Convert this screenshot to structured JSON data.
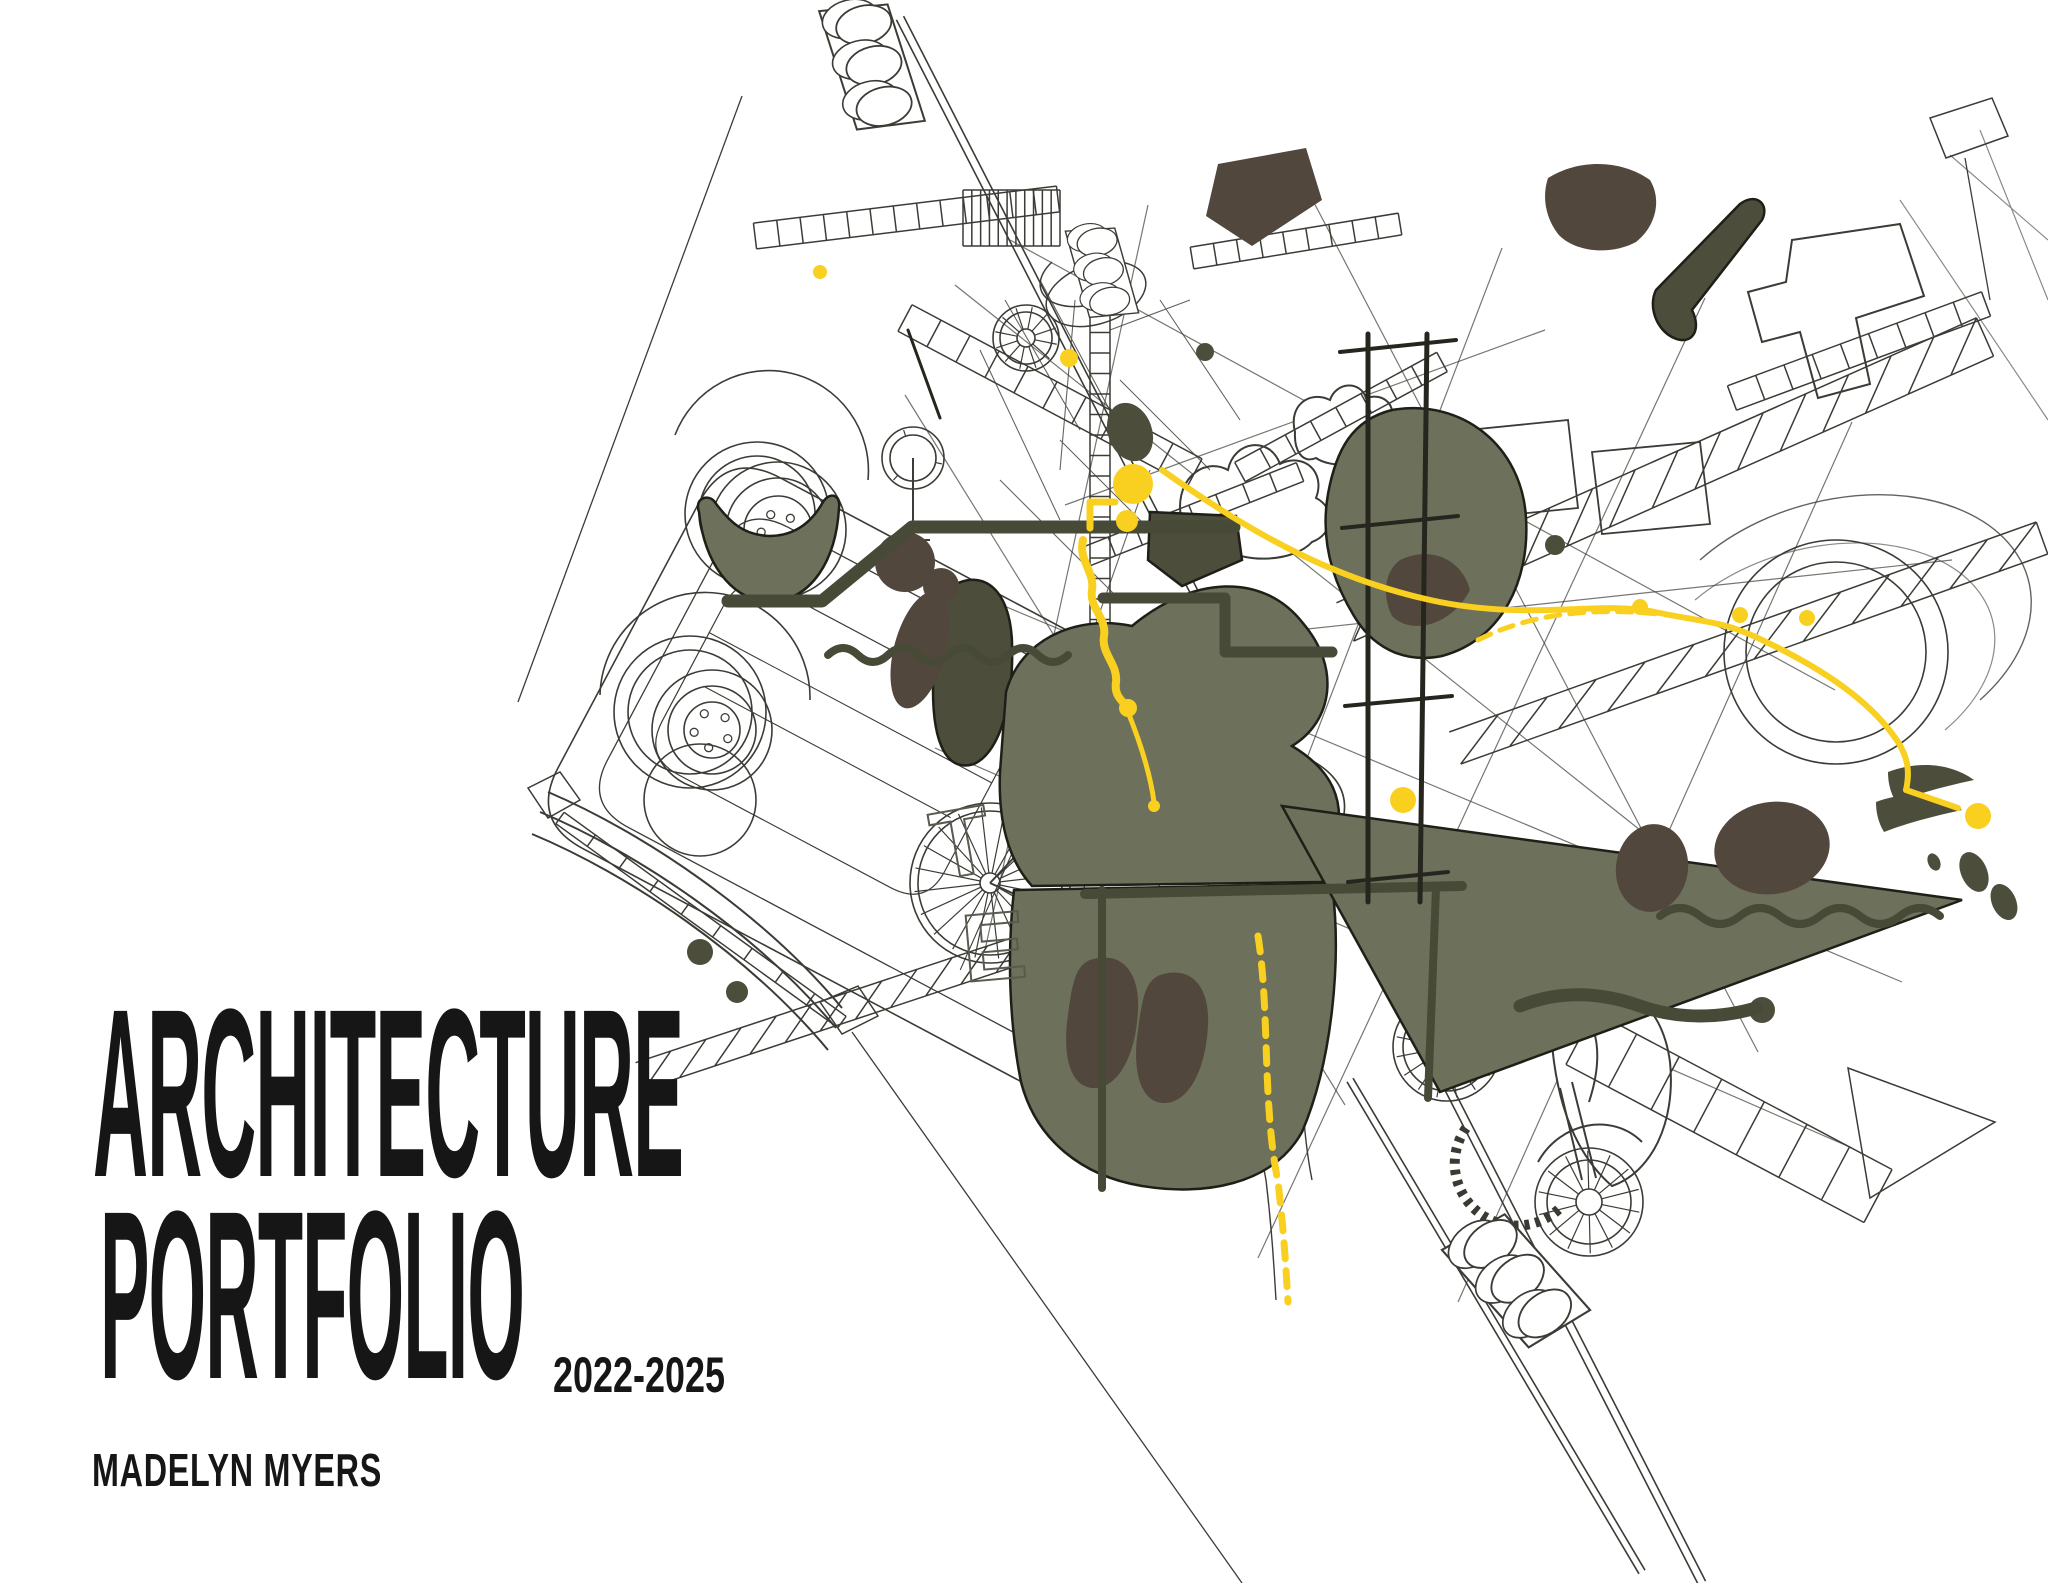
{
  "title": {
    "line1": "ARCHITECTURE",
    "line2": "PORTFOLIO",
    "years": "2022-2025"
  },
  "author": "MADELYN MYERS",
  "colors": {
    "paper": "#ffffff",
    "ink": "#161616",
    "wire": "#3c3c36",
    "olive": "#6d705a",
    "olive_dark": "#4c4e3b",
    "dark_brown": "#52473d",
    "accent": "#f9d020",
    "tube": "#484a38"
  },
  "illustration": {
    "description": "exploded isometric collage of wireframe vehicles, scaffolding, ladders and traffic lights with olive silhouettes and yellow wayfinding dots",
    "wires": [
      {
        "d": "M-270,-210 L330,-210 Q390,-210 390,-150 L390,150 Q390,210 330,210 L-270,210 Q-330,210 -330,150 L-330,-150 Q-330,-210 -270,-210 Z",
        "tf": "translate(920,790) rotate(28)",
        "w": 1.6
      },
      {
        "d": "M-240,-170 L300,-170 Q350,-170 350,-120 L350,120 Q350,170 300,170 L-240,170 Q-290,170 -290,120 L-290,-120 Q-290,-170 -240,-170 Z",
        "tf": "translate(920,790) rotate(28)",
        "w": 1.3
      },
      {
        "d": "M-220,-110 L20,-110 Q60,-110 60,-70 L60,60 Q60,100 20,100 L-220,100 Q-260,100 -260,60 L-260,-70 Q-260,-110 -220,-110 Z",
        "tf": "translate(920,790) rotate(28)",
        "w": 1.2
      },
      {
        "d": "M-260,-40 L60,-40 M-240,10 L40,10 M100,-140 L120,140 M180,-150 L200,150 M250,-160 L265,160",
        "tf": "translate(920,790) rotate(28)",
        "w": 1.1
      },
      {
        "d": "M675,435 A100,100 0 0 1 868,480",
        "w": 1.6
      },
      {
        "d": "M600,695 A105,105 0 0 1 810,700",
        "w": 1.6
      },
      {
        "d": "M913,458 L913,540 M898,540 L930,540",
        "w": 2
      },
      {
        "d": "M955,285 L1640,830",
        "w": 1.2,
        "o": 0.7
      },
      {
        "d": "M1010,240 L1835,690",
        "w": 1.2,
        "o": 0.7
      },
      {
        "d": "M905,395 L1345,1105",
        "w": 1.2,
        "o": 0.7
      },
      {
        "d": "M1148,205 L985,950",
        "w": 1.2,
        "o": 0.7
      },
      {
        "d": "M1298,172 L1758,1052",
        "w": 1.2,
        "o": 0.7
      },
      {
        "d": "M1502,248 L1158,1148",
        "w": 1.2,
        "o": 0.7
      },
      {
        "d": "M1705,298 L1258,1258",
        "w": 1.2,
        "o": 0.7
      },
      {
        "d": "M1852,422 L1458,1302",
        "w": 1.2,
        "o": 0.7
      },
      {
        "d": "M985,598 L1902,982",
        "w": 1.2,
        "o": 0.7
      },
      {
        "d": "M935,748 L1852,1148",
        "w": 1.2,
        "o": 0.7
      },
      {
        "d": "M1065,505 L1545,330",
        "w": 1.2,
        "o": 0.7
      },
      {
        "d": "M1205,640 L1952,560",
        "w": 1.2,
        "o": 0.7
      },
      {
        "d": "M1182,522 C1172,482 1202,456 1228,470 C1234,440 1270,436 1280,464 C1304,452 1326,472 1316,498 C1336,508 1334,534 1312,542 C1294,562 1244,564 1224,548 C1202,558 1184,546 1182,522 Z",
        "f": "#ffffff",
        "w": 2
      },
      {
        "d": "M1295,432 C1288,405 1310,390 1330,400 C1336,382 1360,380 1366,398 C1384,392 1398,406 1390,424 C1402,432 1398,450 1382,454 C1368,468 1330,468 1316,458 C1302,464 1294,450 1295,432 Z",
        "f": "#ffffff",
        "w": 2
      },
      {
        "d": "M1792,240 L1900,224 L1924,296 L1856,318 L1870,384 L1818,398 L1800,332 L1762,342 L1748,292 L1786,282 Z",
        "f": "#ffffff",
        "w": 2
      },
      {
        "d": "M1556,988 C1622,970 1662,1002 1670,1062 C1676,1122 1652,1172 1612,1186 C1582,1160 1562,1120 1554,1062 C1550,1030 1550,1008 1556,988 Z",
        "f": "#ffffff",
        "w": 2
      },
      {
        "d": "M548,792 C642,832 762,912 842,1008",
        "w": 2
      },
      {
        "d": "M540,812 C636,852 756,932 836,1028",
        "w": 2
      },
      {
        "d": "M532,834 C628,874 748,954 828,1050",
        "w": 2
      },
      {
        "d": "M528,788 L560,772 L580,800 L548,818 Z",
        "w": 1.5
      },
      {
        "d": "M820,1002 L858,986 L878,1016 L842,1034 Z",
        "w": 1.5
      },
      {
        "d": "M1848,1068 L1995,1122 L1870,1198 Z",
        "w": 1.5
      },
      {
        "d": "M1930,118 L1992,98 L2008,136 L1946,158 Z",
        "w": 1.5
      },
      {
        "d": "M1965,158 L1990,300",
        "w": 1.3
      },
      {
        "d": "M1447,1047 C1482,1002 1532,982 1572,1002 C1602,1022 1602,1062 1589,1102",
        "w": 2
      },
      {
        "d": "M1560,1088 L1582,1180 M1572,1082 L1596,1178",
        "w": 2
      },
      {
        "d": "M1538,1162 C1560,1122 1612,1112 1642,1142",
        "w": 2
      },
      {
        "d": "M990,883 L1085,782 L1152,852 M990,883 L1098,932",
        "w": 2
      },
      {
        "d": "M1058,282 A38,22 -18 1 0 1134,306 A38,22 -18 1 0 1058,282 Z",
        "w": 1.5
      },
      {
        "d": "M1052,262 A38,22 -18 1 0 1128,286",
        "w": 1.5
      },
      {
        "d": "M1448,432 L1568,420 L1578,508 L1458,520 Z",
        "w": 1.8
      },
      {
        "d": "M1592,452 L1700,442 L1710,524 L1602,534 Z",
        "w": 1.8
      },
      {
        "d": "M1466,1128 A62,62 0 0 0 1562,1206",
        "w": 10,
        "s": "#3a3a33",
        "dash": "5 6"
      },
      {
        "d": "M1005,300 L1080,430 M1040,280 L1115,420 M1075,300 L1060,470 M1110,330 L1190,300 M980,350 L1060,520 M1120,380 L1210,470 M1160,300 L1240,420 M1060,440 L1180,560 M1000,480 L1120,600 M1150,470 L1090,640",
        "w": 1.1,
        "o": 0.8
      },
      {
        "d": "M1950,155 L2048,240 M1980,130 L2048,300 M1900,200 L2048,420",
        "w": 1.2,
        "o": 0.6
      },
      {
        "d": "M1700,560 A180,120 -15 0 1 1980,700",
        "w": 1.4,
        "o": 0.8
      },
      {
        "d": "M1695,600 A160,105 -15 0 1 1945,730",
        "w": 1.2,
        "o": 0.6
      },
      {
        "d": "M1246,930 C1258,1010 1250,1100 1266,1180 C1272,1230 1274,1268 1276,1300 M1292,930 C1304,1010 1296,1100 1312,1180",
        "w": 1.4
      }
    ],
    "ladders": [
      {
        "p": [
          755,
          236,
          1058,
          199
        ],
        "w": 26,
        "n": 13
      },
      {
        "p": [
          1192,
          258,
          1400,
          224
        ],
        "w": 22,
        "n": 9
      },
      {
        "p": [
          963,
          218,
          1060,
          218
        ],
        "w": 56,
        "n": 11
      },
      {
        "p": [
          905,
          318,
          1195,
          472
        ],
        "w": 30,
        "n": 10
      },
      {
        "p": [
          1240,
          472,
          1442,
          362
        ],
        "w": 22,
        "n": 8
      },
      {
        "p": [
          1345,
          622,
          1985,
          337
        ],
        "w": 42,
        "n": 15,
        "lat": 1
      },
      {
        "p": [
          1455,
          748,
          2042,
          538
        ],
        "w": 34,
        "n": 12,
        "lat": 1
      },
      {
        "p": [
          640,
          1076,
          1062,
          936
        ],
        "w": 28,
        "n": 12,
        "lat": 1
      },
      {
        "p": [
          560,
          818,
          842,
          1022
        ],
        "w": 14,
        "n": 9
      },
      {
        "p": [
          1580,
          1038,
          1878,
          1196
        ],
        "w": 60,
        "n": 7
      },
      {
        "p": [
          1100,
          312,
          1100,
          640
        ],
        "w": 20,
        "n": 16
      },
      {
        "p": [
          1732,
          398,
          1986,
          304
        ],
        "w": 26,
        "n": 9
      },
      {
        "p": [
          1085,
          557,
          1300,
          472
        ],
        "w": 20,
        "n": 8
      }
    ],
    "poles": [
      [
        900,
        18,
        1702,
        1583,
        8
      ],
      [
        742,
        96,
        518,
        702,
        0
      ],
      [
        852,
        1032,
        1242,
        1583,
        0
      ],
      [
        1350,
        1080,
        1642,
        1572,
        7
      ]
    ],
    "lights": [
      {
        "cx": 872,
        "cy": 66,
        "rot": -14,
        "s": 1
      },
      {
        "cx": 1102,
        "cy": 272,
        "rot": -12,
        "s": 0.72
      },
      {
        "cx": 1516,
        "cy": 1280,
        "rot": -38,
        "s": 1.05
      }
    ],
    "wheels": [
      {
        "cx": 757,
        "cy": 514,
        "r": [
          72,
          58
        ]
      },
      {
        "cx": 778,
        "cy": 530,
        "r": [
          68,
          52,
          34
        ],
        "bolts": 5,
        "br": 17
      },
      {
        "cx": 690,
        "cy": 712,
        "r": [
          76,
          62
        ]
      },
      {
        "cx": 712,
        "cy": 730,
        "r": [
          60,
          44,
          28
        ],
        "bolts": 5,
        "br": 18
      },
      {
        "cx": 700,
        "cy": 800,
        "r": [
          56
        ]
      },
      {
        "cx": 913,
        "cy": 458,
        "r": [
          31,
          23
        ],
        "spokes": 3
      },
      {
        "cx": 1026,
        "cy": 338,
        "r": [
          33,
          26,
          9
        ],
        "spokes": 12
      },
      {
        "cx": 990,
        "cy": 883,
        "r": [
          80,
          72,
          10
        ],
        "spokes": 20
      },
      {
        "cx": 1104,
        "cy": 936,
        "r": [
          20
        ]
      },
      {
        "cx": 1447,
        "cy": 1047,
        "r": [
          54,
          44,
          14
        ],
        "spokes": 16
      },
      {
        "cx": 1589,
        "cy": 1202,
        "r": [
          54,
          42,
          13
        ],
        "spokes": 14
      },
      {
        "cx": 1836,
        "cy": 652,
        "r": [
          112,
          90
        ]
      }
    ],
    "blobs": [
      {
        "d": "M699,512 C694,498 708,494 714,501 C730,523 744,535 769,536 C797,536 813,520 823,502 C830,491 841,495 839,508 C836,560 812,600 770,602 C729,600 704,560 699,512 Z",
        "f": "olive"
      },
      {
        "d": "M1392,410 C1462,398 1522,446 1526,518 C1530,580 1502,640 1442,656 C1402,664 1372,646 1354,616 C1332,580 1320,540 1328,494 C1336,450 1352,420 1392,410 Z",
        "f": "olive"
      },
      {
        "d": "M1400,560 C1432,545 1462,560 1470,590 C1452,625 1412,636 1392,616 C1382,596 1384,572 1400,560 Z",
        "f": "dark",
        "ns": 1
      },
      {
        "d": "M952,586 C984,568 1010,590 1012,642 C1014,702 1000,752 974,764 C948,772 933,746 933,690 C933,640 932,602 952,586 Z",
        "f": "olive2"
      },
      {
        "d": "M1006,692 C1020,640 1076,614 1132,626 C1192,576 1262,572 1302,622 C1342,668 1332,722 1292,746 C1332,770 1346,800 1336,842 L1322,882 L1032,886 C1008,860 998,820 1000,772 Z",
        "f": "olive"
      },
      {
        "d": "M1014,890 L1332,884 C1342,960 1332,1062 1302,1132 C1272,1186 1202,1196 1142,1186 C1082,1176 1036,1140 1021,1082 C1009,1022 1007,952 1014,890 Z",
        "f": "olive"
      },
      {
        "d": "M1090,960 C1120,950 1140,970 1138,1010 C1136,1055 1118,1090 1092,1088 C1070,1086 1062,1055 1068,1015 C1072,985 1075,966 1090,960 Z",
        "f": "dark",
        "ns": 1
      },
      {
        "d": "M1160,975 C1190,965 1210,985 1208,1025 C1206,1070 1188,1105 1162,1103 C1140,1101 1132,1070 1138,1030 C1142,1000 1145,981 1160,975 Z",
        "f": "dark",
        "ns": 1
      },
      {
        "d": "M1282,806 L1962,900 L1440,1092 Z",
        "f": "olive"
      },
      {
        "d": "M1888,772 C1920,760 1952,764 1974,780 C1946,786 1916,794 1896,802 C1890,792 1888,782 1888,772 Z",
        "f": "olive2",
        "ns": 1
      },
      {
        "d": "M1876,802 C1908,790 1940,794 1962,810 C1934,816 1904,824 1884,832 C1878,822 1876,812 1876,802 Z",
        "f": "olive2",
        "ns": 1
      },
      {
        "d": "M1548,178 C1580,158 1622,160 1650,180 C1662,200 1656,226 1636,242 C1610,256 1574,252 1558,234 C1545,217 1542,196 1548,178 Z",
        "f": "dark",
        "ns": 1
      },
      {
        "d": "M1218,164 L1306,148 L1322,200 L1252,246 L1206,216 Z",
        "f": "dark",
        "ns": 1
      },
      {
        "d": "M1656,290 L1740,204 C1756,192 1770,204 1762,220 L1692,310 C1702,330 1692,346 1674,338 C1656,330 1648,306 1656,290 Z",
        "f": "olive2"
      },
      {
        "d": "M1150,512 L1236,516 L1242,560 L1182,586 L1148,560 Z",
        "f": "olive2"
      },
      {
        "e": 1,
        "cx": 905,
        "cy": 562,
        "rx": 30,
        "ry": 30,
        "f": "dark",
        "ns": 1
      },
      {
        "e": 1,
        "cx": 941,
        "cy": 586,
        "rx": 18,
        "ry": 18,
        "f": "dark",
        "ns": 1
      },
      {
        "e": 1,
        "cx": 920,
        "cy": 650,
        "rx": 26,
        "ry": 60,
        "rot": 15,
        "f": "dark",
        "ns": 1
      },
      {
        "e": 1,
        "cx": 1772,
        "cy": 848,
        "rx": 58,
        "ry": 46,
        "rot": -10,
        "f": "dark",
        "ns": 1
      },
      {
        "e": 1,
        "cx": 1652,
        "cy": 868,
        "rx": 36,
        "ry": 44,
        "rot": 8,
        "f": "dark",
        "ns": 1
      },
      {
        "e": 1,
        "cx": 1130,
        "cy": 432,
        "rx": 22,
        "ry": 30,
        "rot": -20,
        "f": "olive2",
        "ns": 1
      },
      {
        "e": 1,
        "cx": 700,
        "cy": 952,
        "rx": 13,
        "ry": 13,
        "f": "olive2",
        "ns": 1
      },
      {
        "e": 1,
        "cx": 737,
        "cy": 992,
        "rx": 11,
        "ry": 11,
        "f": "olive2",
        "ns": 1
      },
      {
        "e": 1,
        "cx": 1205,
        "cy": 352,
        "rx": 9,
        "ry": 9,
        "f": "olive2",
        "ns": 1
      },
      {
        "e": 1,
        "cx": 1555,
        "cy": 545,
        "rx": 10,
        "ry": 10,
        "f": "olive2",
        "ns": 1
      },
      {
        "e": 1,
        "cx": 1974,
        "cy": 872,
        "rx": 13,
        "ry": 21,
        "rot": -24,
        "f": "olive2",
        "ns": 1
      },
      {
        "e": 1,
        "cx": 2004,
        "cy": 902,
        "rx": 12,
        "ry": 19,
        "rot": -24,
        "f": "olive2",
        "ns": 1
      },
      {
        "e": 1,
        "cx": 1934,
        "cy": 862,
        "rx": 6,
        "ry": 9,
        "rot": -24,
        "f": "olive2",
        "ns": 1
      },
      {
        "e": 1,
        "cx": 1762,
        "cy": 1010,
        "rx": 13,
        "ry": 13,
        "f": "olive2",
        "ns": 1
      }
    ],
    "tubes": [
      {
        "d": "M728,601 L822,601 L912,527 L1146,527",
        "w": 13
      },
      {
        "d": "M1152,527 L1234,527",
        "w": 13
      },
      {
        "d": "M1103,598 L1225,598 L1225,652 L1332,652",
        "w": 11
      },
      {
        "d": "M828,655 q15,-14 30,0 t30,0 t30,0 t30,0 t30,0 t30,0 t30,0 t30,0",
        "w": 8
      },
      {
        "d": "M1660,916 q20,-16 40,0 t40,0 t40,0 t40,0 t40,0 t40,0 t40,0",
        "w": 8
      },
      {
        "d": "M1520,1006 C1560,990 1600,992 1640,1006 C1680,1020 1722,1018 1756,1008",
        "w": 13
      },
      {
        "d": "M1085,894 L1462,886",
        "w": 10
      },
      {
        "d": "M1102,890 L1102,1188",
        "w": 8
      },
      {
        "d": "M1436,888 L1428,1098",
        "w": 8
      },
      {
        "d": "M1368,334 L1368,902",
        "w": 5,
        "c": "#26261f"
      },
      {
        "d": "M1427,334 L1420,902",
        "w": 5,
        "c": "#26261f"
      },
      {
        "d": "M1340,352 L1456,340 M1342,528 L1458,516 M1345,706 L1452,696 M1348,882 L1448,872",
        "w": 4,
        "c": "#26261f"
      },
      {
        "d": "M940,418 L908,330",
        "w": 3,
        "c": "#26261f"
      }
    ],
    "ypaths": [
      {
        "d": "M1083,540 C1078,560 1095,572 1092,590 C1089,608 1107,618 1104,636 C1101,654 1118,664 1116,682 C1114,696 1122,700 1126,706",
        "w": 8
      },
      {
        "d": "M1090,502 L1115,502 M1090,502 L1090,528",
        "w": 7
      },
      {
        "d": "M1128,712 C1140,742 1150,772 1154,802",
        "w": 5
      },
      {
        "d": "M1162,470 C1260,540 1340,580 1430,600 C1530,622 1600,600 1655,612 C1700,622 1722,620 1762,640 C1822,668 1872,702 1898,742 C1908,758 1910,772 1906,790",
        "w": 6
      },
      {
        "d": "M1906,790 L1958,808",
        "w": 6
      },
      {
        "d": "M1258,936 C1270,1012 1262,1102 1278,1182 C1284,1232 1286,1270 1288,1302",
        "w": 7,
        "dash": "16 12"
      },
      {
        "d": "M1478,640 Q1560,598 1690,618",
        "w": 5,
        "dash": "14 10"
      }
    ],
    "dots": [
      [
        820,
        272,
        7
      ],
      [
        1069,
        358,
        9
      ],
      [
        1133,
        484,
        20
      ],
      [
        1127,
        521,
        11
      ],
      [
        1128,
        708,
        9
      ],
      [
        1154,
        806,
        6
      ],
      [
        1640,
        607,
        8
      ],
      [
        1740,
        615,
        8
      ],
      [
        1807,
        618,
        8
      ],
      [
        1978,
        816,
        13
      ],
      [
        1403,
        800,
        13
      ]
    ],
    "letters": [
      {
        "ch": "T",
        "x": 938,
        "y": 880,
        "rot": -10
      },
      {
        "ch": "E",
        "x": 965,
        "y": 982,
        "rot": -5
      }
    ]
  }
}
